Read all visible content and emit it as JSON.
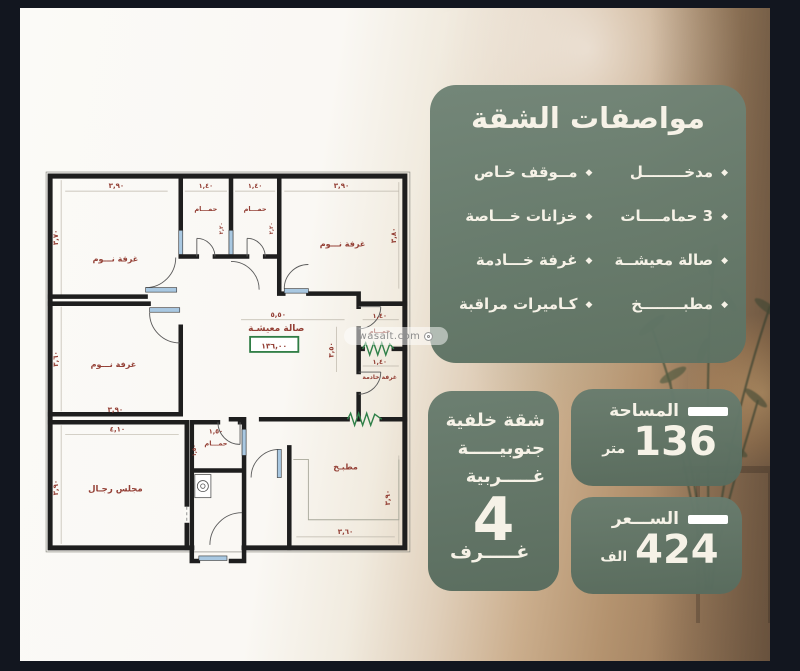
{
  "watermark": {
    "text": "wasalt.com"
  },
  "plan": {
    "rooms": [
      "غرفة نـــوم",
      "حمـــام",
      "حمـــام",
      "غرفة نـــوم",
      "غرفة نـــوم",
      "صالة معيشـة",
      "حمـــام",
      "غرفة خادمة",
      "مجلس رجـال",
      "حمـــام",
      "مطبـخ"
    ],
    "dims": [
      "٣,٩٠",
      "١,٤٠",
      "١,٤٠",
      "٣,٩٠",
      "٣,٧٠",
      "٢,٢٠",
      "٢,٢٠",
      "٣,٨٠",
      "٣,٦٠",
      "٣,٩٠",
      "٥,٥٠",
      "٣,٥٠",
      "١,٤٠",
      "١,٤٠",
      "٤,١٠",
      "٣,٩٠",
      "١,٥٠",
      "٣,٦٠",
      "٣,٩٠",
      "١,٥٠"
    ],
    "area_value": "١٣٦,٠٠"
  },
  "specs_panel": {
    "title": "مواصفات الشقة",
    "bullet": "◆",
    "items_right": [
      "مدخــــــــل",
      "3 حمامــــات",
      "صالة معيشــة",
      "مطبــــــــخ"
    ],
    "items_left": [
      "مــوقف خـاص",
      "خزانات خـــاصة",
      "غرفة خـــادمة",
      "كـاميرات مراقبة"
    ]
  },
  "info_boxes": {
    "orientation": {
      "line1": "شقة خلفية",
      "line2": "جنوبيـــــة",
      "line3": "غـــــربية",
      "count": "4",
      "count_label": "غـــــرف"
    },
    "area": {
      "label": "المساحة",
      "value": "136",
      "unit": "متر"
    },
    "price": {
      "label": "الســـعر",
      "value": "424",
      "unit": "الف"
    }
  },
  "colors": {
    "panel_green": "#66796b",
    "frame_dark": "#12161f",
    "plan_maroon": "#944036",
    "plan_green": "#2f7d45"
  }
}
